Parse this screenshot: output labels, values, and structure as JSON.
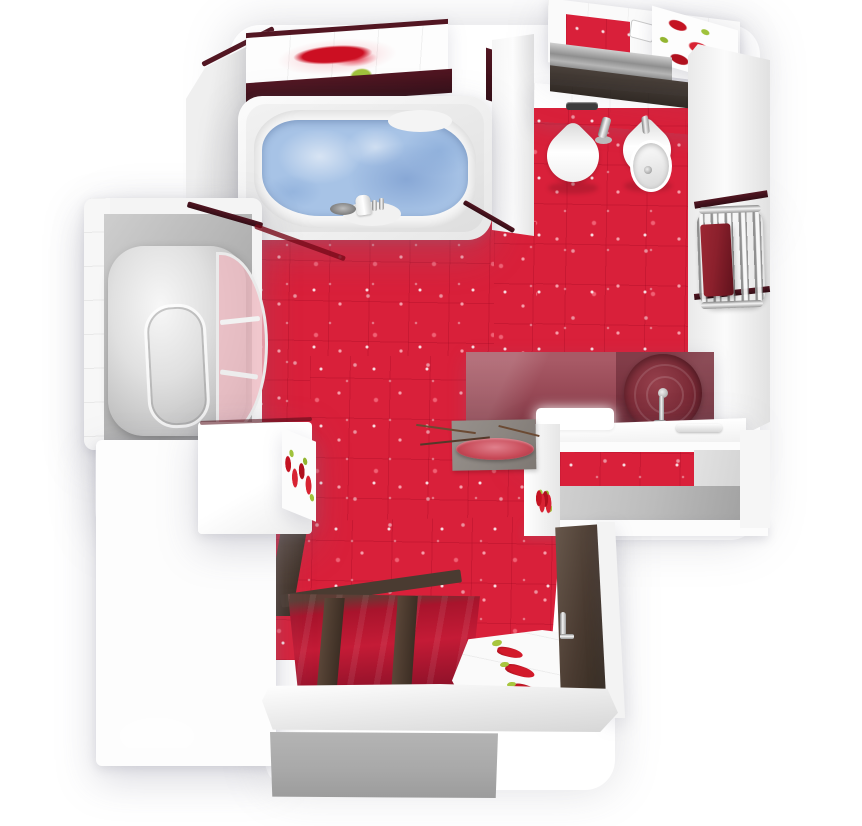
{
  "scene": {
    "type": "3d-bathroom-floor-plan-top-view",
    "room": "bathroom",
    "decor_theme": "red sparkle tiles with chili-pepper decor strips"
  },
  "colors": {
    "floor_red": "#d9203a",
    "floor_red_dark": "#a8142c",
    "accent_maroon": "#521622",
    "wood_brown": "#4a3b31",
    "shelf_brown": "#49403a",
    "wall_white": "#f6f6f6",
    "wall_gray": "#ababab",
    "water_blue": "#a7c3e6",
    "water_blue_deep": "#7fa3d4",
    "glass_maroon": "#9a4b58",
    "glass_maroon_dark": "#6e2a34",
    "sink_maroon": "#7a2a36",
    "towel_red": "#8b202c",
    "chrome": "#c9c9c9",
    "pepper_red": "#c41322",
    "leaf_green": "#a0c23c",
    "step_gray": "#a9a9a9",
    "mat_gray": "#8b8580",
    "plate_pink": "#c84a58"
  },
  "objects": [
    {
      "name": "bathtub",
      "label": "Bathtub filled with water"
    },
    {
      "name": "shower-cabin",
      "label": "Corner shower cabin"
    },
    {
      "name": "toilet",
      "label": "Toilet"
    },
    {
      "name": "bidet",
      "label": "Bidet"
    },
    {
      "name": "washbasin",
      "label": "Round vessel washbasin"
    },
    {
      "name": "vanity-counter",
      "label": "Floating vanity counter"
    },
    {
      "name": "towel-radiator",
      "label": "Towel radiator with red towel"
    },
    {
      "name": "entry-door",
      "label": "Wooden entry door"
    },
    {
      "name": "decor-mat",
      "label": "Gray mat with decorative plate"
    },
    {
      "name": "step",
      "label": "Entry step"
    }
  ]
}
